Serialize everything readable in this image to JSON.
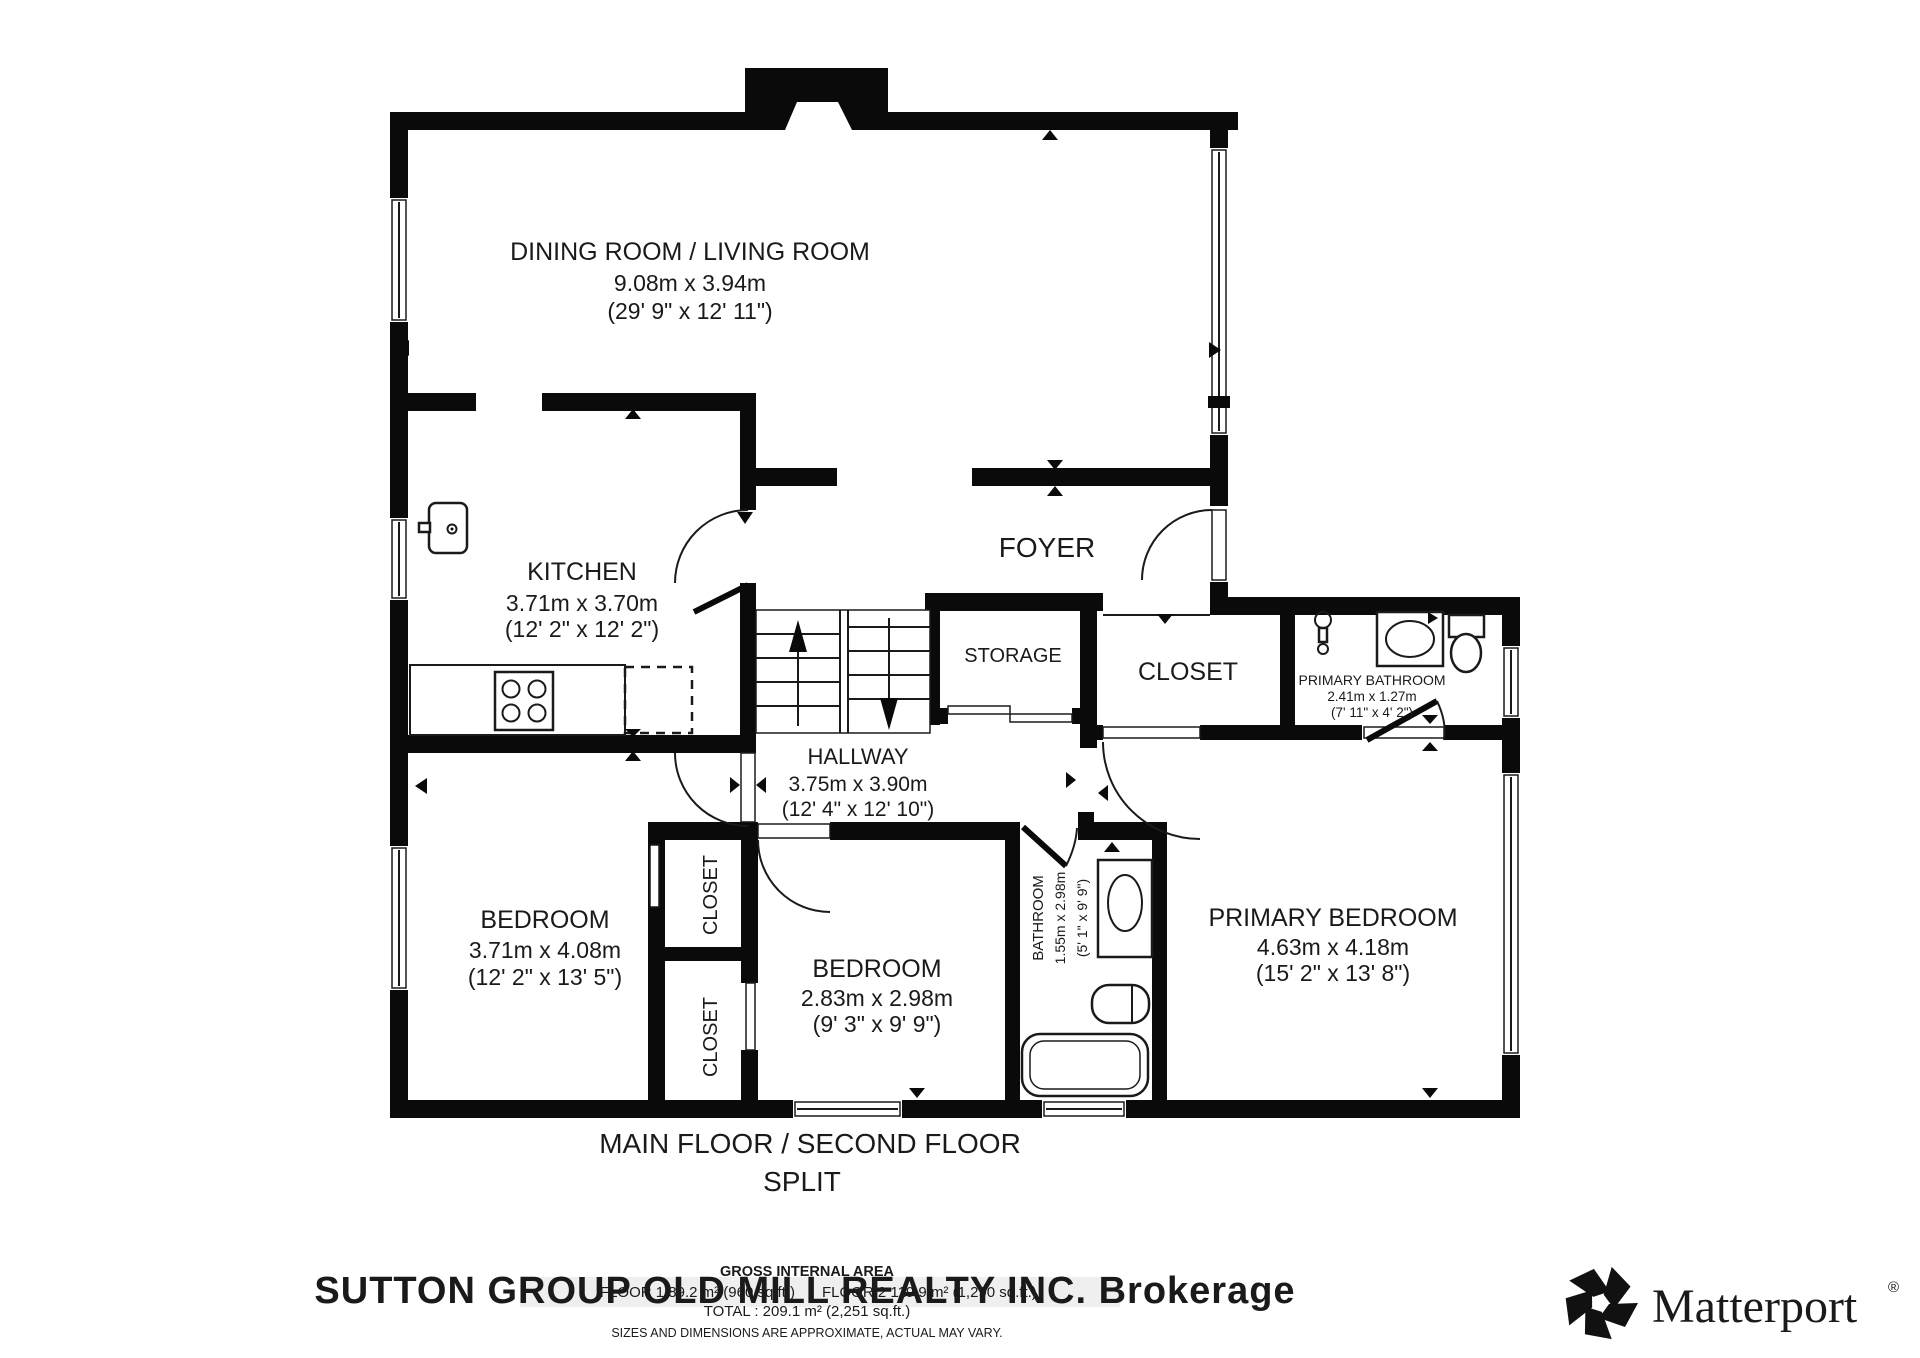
{
  "rooms": {
    "living": {
      "name": "DINING ROOM / LIVING ROOM",
      "dims_m": "9.08m x 3.94m",
      "dims_ft": "(29' 9\" x 12' 11\")"
    },
    "kitchen": {
      "name": "KITCHEN",
      "dims_m": "3.71m x 3.70m",
      "dims_ft": "(12' 2\" x 12' 2\")"
    },
    "foyer": {
      "name": "FOYER"
    },
    "storage": {
      "name": "STORAGE"
    },
    "closet_front": {
      "name": "CLOSET"
    },
    "primary_bathroom": {
      "name": "PRIMARY BATHROOM",
      "dims_m": "2.41m x 1.27m",
      "dims_ft": "(7' 11\" x 4' 2\")"
    },
    "hallway": {
      "name": "HALLWAY",
      "dims_m": "3.75m x 3.90m",
      "dims_ft": "(12' 4\" x 12' 10\")"
    },
    "bedroom_left": {
      "name": "BEDROOM",
      "dims_m": "3.71m x 4.08m",
      "dims_ft": "(12' 2\" x 13' 5\")"
    },
    "closet_upper": {
      "name": "CLOSET"
    },
    "closet_lower": {
      "name": "CLOSET"
    },
    "bedroom_middle": {
      "name": "BEDROOM",
      "dims_m": "2.83m x 2.98m",
      "dims_ft": "(9' 3\" x 9' 9\")"
    },
    "bathroom": {
      "name": "BATHROOM",
      "dims_m": "1.55m x 2.98m",
      "dims_ft": "(5' 1\" x 9' 9\")"
    },
    "primary_bedroom": {
      "name": "PRIMARY BEDROOM",
      "dims_m": "4.63m x 4.18m",
      "dims_ft": "(15' 2\" x 13' 8\")"
    }
  },
  "title": {
    "line1": "MAIN FLOOR / SECOND FLOOR",
    "line2": "SPLIT"
  },
  "footer": {
    "heading": "GROSS INTERNAL AREA",
    "floor1": "FLOOR 1 89.2 m² (960 sq.ft.)",
    "floor2": "FLOOR 2 119.9 m² (1,290 sq.ft.)",
    "total": "TOTAL :  209.1 m² (2,251 sq.ft.)",
    "disclaimer": "SIZES AND DIMENSIONS ARE APPROXIMATE, ACTUAL MAY VARY."
  },
  "watermark": {
    "text": "SUTTON GROUP OLD MILL REALTY INC. Brokerage"
  },
  "branding": {
    "logo_text": "Matterport",
    "registered": "®",
    "icon": "matterport-pinwheel-icon"
  },
  "colors": {
    "wall": "#0a0a0a",
    "watermark": "#d0d0d0",
    "background": "#ffffff"
  }
}
